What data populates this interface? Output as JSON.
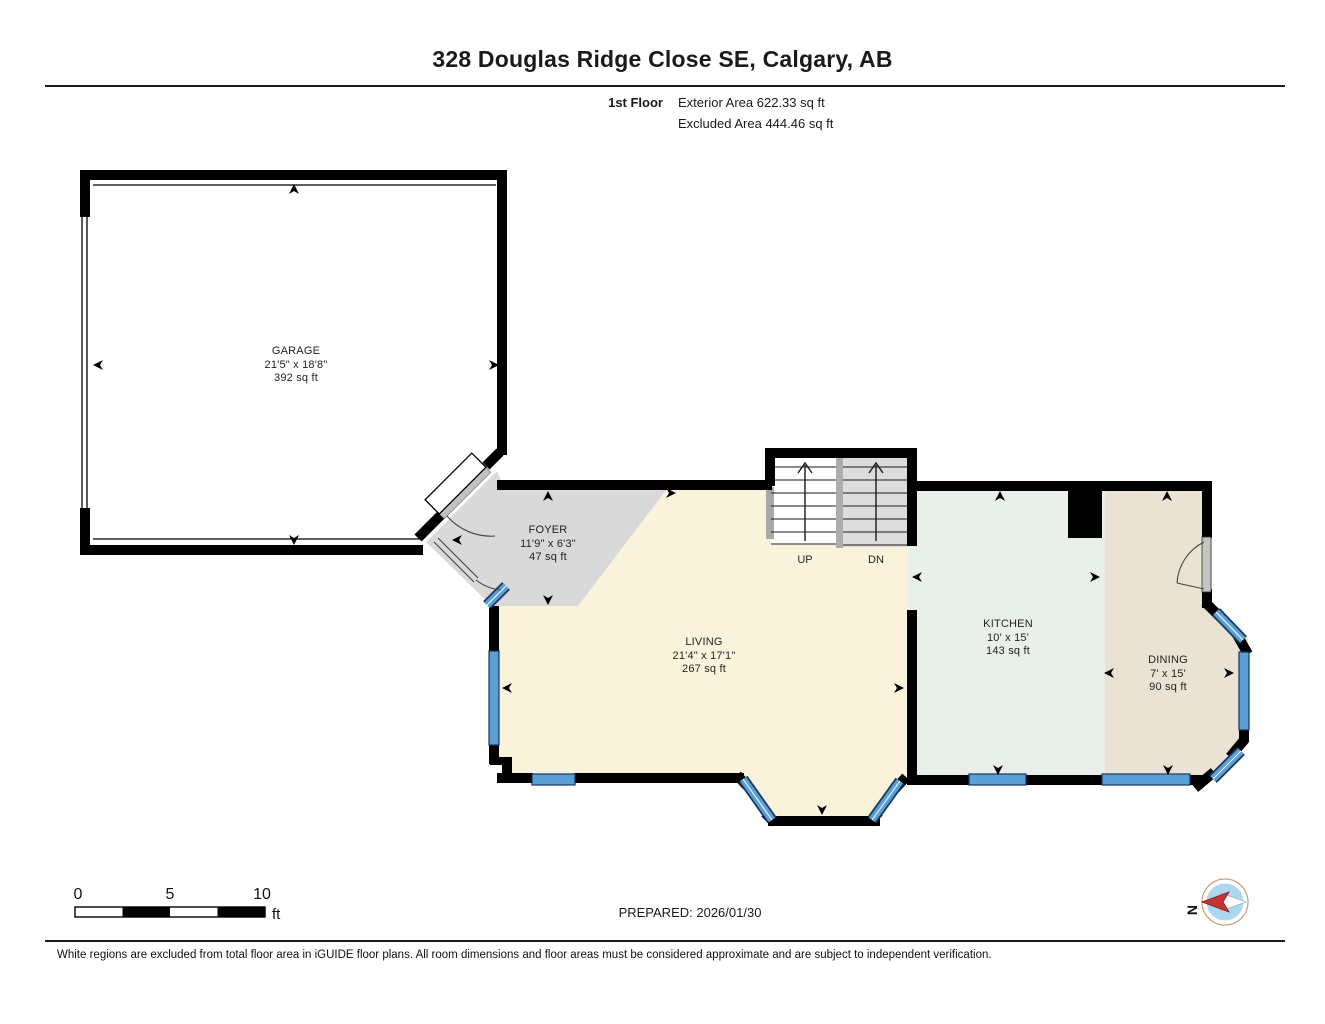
{
  "header": {
    "title": "328 Douglas Ridge Close SE, Calgary, AB",
    "floor_label": "1st Floor",
    "exterior_area": "Exterior Area 622.33 sq ft",
    "excluded_area": "Excluded Area 444.46 sq ft"
  },
  "rooms": [
    {
      "name": "GARAGE",
      "dims": "21'5\" x 18'8\"",
      "area": "392 sq ft"
    },
    {
      "name": "FOYER",
      "dims": "11'9\" x 6'3\"",
      "area": "47 sq ft"
    },
    {
      "name": "LIVING",
      "dims": "21'4\" x 17'1\"",
      "area": "267 sq ft"
    },
    {
      "name": "KITCHEN",
      "dims": "10' x 15'",
      "area": "143 sq ft"
    },
    {
      "name": "DINING",
      "dims": "7' x 15'",
      "area": "90 sq ft"
    }
  ],
  "stairs": {
    "up": "UP",
    "down": "DN"
  },
  "scale_bar": {
    "tick0": "0",
    "tick5": "5",
    "tick10": "10",
    "unit": "ft"
  },
  "prepared": "PREPARED: 2026/01/30",
  "compass": {
    "north": "N"
  },
  "footer": "White regions are excluded from total floor area in iGUIDE floor plans. All room dimensions and floor areas must be considered approximate and are subject to independent verification.",
  "colors": {
    "wall": "#000000",
    "garage_fill": "#FFFFFF",
    "foyer_fill": "#D9D9D9",
    "living_fill": "#FAF3DC",
    "kitchen_fill": "#E9F0E9",
    "dining_fill": "#EAE2D3",
    "window_blue": "#5B9FD6",
    "window_frame": "#17375E",
    "stair_dn_fill": "#DCDCDC",
    "compass_ring": "#CE9E72",
    "compass_face": "#ABD7EF",
    "compass_needle_red": "#C43535"
  }
}
